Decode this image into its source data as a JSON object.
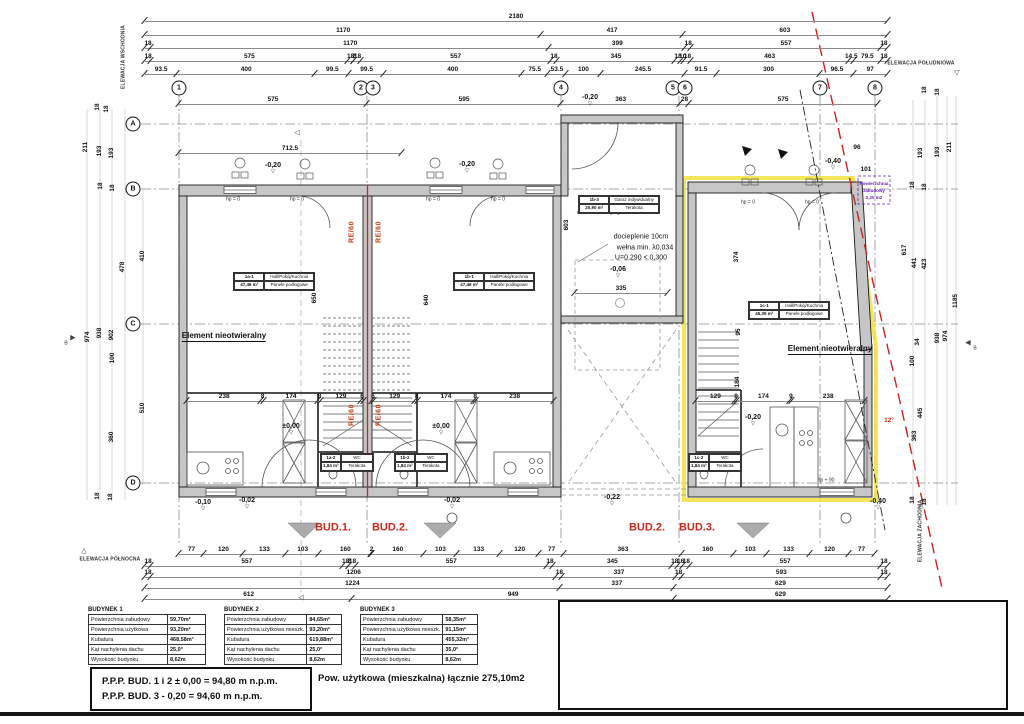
{
  "colors": {
    "highlight_yellow": "#f3e23c",
    "boundary_red": "#cc2222",
    "note_purple": "#6a1fb8",
    "wall_gray": "#c6c6c6"
  },
  "grid": {
    "cols": [
      [
        "1",
        179
      ],
      [
        "2",
        361
      ],
      [
        "3",
        373
      ],
      [
        "4",
        561
      ],
      [
        "5",
        673
      ],
      [
        "6",
        685
      ],
      [
        "7",
        820
      ],
      [
        "8",
        875
      ]
    ],
    "rows": [
      [
        "A",
        124
      ],
      [
        "B",
        189
      ],
      [
        "C",
        324
      ],
      [
        "D",
        483
      ]
    ]
  },
  "dim_rows": [
    {
      "x": 145,
      "y": 12,
      "w": 742,
      "vals": [
        "2180"
      ]
    },
    {
      "x": 145,
      "y": 26,
      "w": 742,
      "vals": [
        "1170",
        "417",
        "603"
      ]
    },
    {
      "x": 145,
      "y": 39,
      "w": 742,
      "vals": [
        "18",
        "1170",
        "399",
        "18",
        "557",
        "18"
      ]
    },
    {
      "x": 145,
      "y": 52,
      "w": 742,
      "vals": [
        "18",
        "575",
        "18",
        "2",
        "18",
        "557",
        "18",
        "345",
        "18",
        "10",
        "18",
        "463",
        "14.5",
        "79.5",
        "18"
      ]
    },
    {
      "x": 145,
      "y": 65,
      "w": 742,
      "vals": [
        "93.5",
        "400",
        "99.5",
        "99.5",
        "400",
        "75.5",
        "53.5",
        "100",
        "245.5",
        "91.5",
        "300",
        "96.5",
        "97"
      ]
    },
    {
      "x": 179,
      "y": 95,
      "w": 698,
      "vals": [
        "575",
        "595",
        "363",
        "28",
        "575"
      ]
    },
    {
      "x": 179,
      "y": 144,
      "w": 222,
      "vals": [
        "712.5"
      ]
    },
    {
      "x": 575,
      "y": 284,
      "w": 92,
      "vals": [
        "335"
      ]
    },
    {
      "x": 187,
      "y": 392,
      "w": 176,
      "vals": [
        "238",
        "8",
        "174",
        "8",
        "129",
        "6"
      ]
    },
    {
      "x": 372,
      "y": 392,
      "w": 181,
      "vals": [
        "6",
        "129",
        "8",
        "174",
        "8",
        "238"
      ]
    },
    {
      "x": 696,
      "y": 392,
      "w": 168,
      "vals": [
        "129",
        "8",
        "174",
        "9",
        "238"
      ]
    },
    {
      "x": 179,
      "y": 545,
      "w": 695,
      "vals": [
        "77",
        "120",
        "133",
        "103",
        "160",
        "2",
        "160",
        "103",
        "133",
        "120",
        "77",
        "363",
        "160",
        "103",
        "133",
        "120",
        "77"
      ]
    },
    {
      "x": 145,
      "y": 557,
      "w": 742,
      "vals": [
        "18",
        "557",
        "18",
        "2",
        "18",
        "557",
        "18",
        "345",
        "18",
        "16",
        "18",
        "557",
        "18"
      ]
    },
    {
      "x": 145,
      "y": 568,
      "w": 742,
      "vals": [
        "18",
        "1206",
        "18",
        "337",
        "18",
        "593",
        "18"
      ]
    },
    {
      "x": 145,
      "y": 579,
      "w": 742,
      "vals": [
        "1224",
        "337",
        "629"
      ]
    },
    {
      "x": 145,
      "y": 590,
      "w": 742,
      "vals": [
        "612",
        "949",
        "629"
      ]
    }
  ],
  "annotations": [
    [
      "211",
      86,
      147,
      "dv"
    ],
    [
      "193",
      100,
      151,
      "dv"
    ],
    [
      "193",
      112,
      153,
      "dv"
    ],
    [
      "18",
      98,
      107,
      "dv"
    ],
    [
      "18",
      107,
      109,
      "dv"
    ],
    [
      "18",
      101,
      186,
      "dv"
    ],
    [
      "18",
      113,
      188,
      "dv"
    ],
    [
      "478",
      123,
      267,
      "dv"
    ],
    [
      "410",
      143,
      256,
      "dv"
    ],
    [
      "938",
      100,
      333,
      "dv"
    ],
    [
      "902",
      112,
      335,
      "dv"
    ],
    [
      "974",
      88,
      337,
      "dv"
    ],
    [
      "100",
      113,
      358,
      "dv"
    ],
    [
      "510",
      143,
      408,
      "dv"
    ],
    [
      "360",
      112,
      437,
      "dv"
    ],
    [
      "18",
      98,
      496,
      "dv"
    ],
    [
      "18",
      111,
      497,
      "dv"
    ],
    [
      "18",
      925,
      90,
      "dv"
    ],
    [
      "18",
      938,
      92,
      "dv"
    ],
    [
      "193",
      921,
      153,
      "dv"
    ],
    [
      "193",
      938,
      152,
      "dv"
    ],
    [
      "211",
      950,
      147,
      "dv"
    ],
    [
      "18",
      913,
      185,
      "dv"
    ],
    [
      "18",
      925,
      187,
      "dv"
    ],
    [
      "441",
      915,
      263,
      "dv"
    ],
    [
      "423",
      925,
      264,
      "dv"
    ],
    [
      "617",
      905,
      250,
      "dv"
    ],
    [
      "938",
      938,
      338,
      "dv"
    ],
    [
      "974",
      946,
      336,
      "dv"
    ],
    [
      "1185",
      956,
      301,
      "dv"
    ],
    [
      "100",
      913,
      361,
      "dv"
    ],
    [
      "34",
      918,
      342,
      "dv"
    ],
    [
      "445",
      921,
      413,
      "dv"
    ],
    [
      "363",
      915,
      436,
      "dv"
    ],
    [
      "18",
      913,
      500,
      "dv"
    ],
    [
      "18",
      925,
      502,
      "dv"
    ],
    [
      "96",
      857,
      148,
      "d"
    ],
    [
      "101",
      866,
      170,
      "d"
    ],
    [
      "650",
      315,
      298,
      "dv"
    ],
    [
      "640",
      427,
      300,
      "dv"
    ],
    [
      "603",
      567,
      225,
      "dv"
    ],
    [
      "374",
      737,
      257,
      "dv"
    ],
    [
      "95",
      739,
      332,
      "dv"
    ],
    [
      "184",
      738,
      382,
      "dv"
    ],
    [
      "158",
      739,
      462,
      "dv"
    ],
    [
      "-0,20",
      273,
      168,
      "l"
    ],
    [
      "-0,20",
      467,
      167,
      "l"
    ],
    [
      "-0,20",
      590,
      100,
      "l"
    ],
    [
      "-0,20",
      753,
      420,
      "l"
    ],
    [
      "±0,00",
      291,
      429,
      "l"
    ],
    [
      "±0,00",
      441,
      429,
      "l"
    ],
    [
      "-0,06",
      618,
      272,
      "l"
    ],
    [
      "-0,10",
      203,
      505,
      "l"
    ],
    [
      "-0,02",
      247,
      503,
      "l"
    ],
    [
      "-0,02",
      452,
      503,
      "l"
    ],
    [
      "-0,22",
      612,
      500,
      "l"
    ],
    [
      "-0,40",
      833,
      164,
      "l"
    ],
    [
      "-0,40",
      878,
      504,
      "l"
    ],
    [
      "BUD.1.",
      333,
      528,
      "r"
    ],
    [
      "BUD.2.",
      390,
      528,
      "r"
    ],
    [
      "BUD.2.",
      647,
      528,
      "r"
    ],
    [
      "BUD.3.",
      697,
      528,
      "r"
    ],
    [
      "RE/60",
      352,
      232,
      "rv"
    ],
    [
      "RE/60",
      379,
      232,
      "rv"
    ],
    [
      "RE/60",
      352,
      415,
      "rv"
    ],
    [
      "RE/60",
      379,
      415,
      "rv"
    ],
    [
      "docieplenie 10cm",
      641,
      237,
      "n"
    ],
    [
      "wełna min. λ0,034",
      645,
      248,
      "n"
    ],
    [
      "U=0,290 < 0,300",
      641,
      258,
      "n"
    ],
    [
      "Element nieotwieralny",
      224,
      337,
      "nb"
    ],
    [
      "Element nieotwieralny",
      830,
      350,
      "nb"
    ],
    [
      "hp = 0",
      233,
      200,
      "t"
    ],
    [
      "hp = 0",
      297,
      200,
      "t"
    ],
    [
      "hp = 0",
      433,
      200,
      "t"
    ],
    [
      "hp = 0",
      498,
      200,
      "t"
    ],
    [
      "hp = 0",
      748,
      203,
      "t"
    ],
    [
      "hp = 0",
      812,
      203,
      "t"
    ],
    [
      "hp + 90",
      826,
      481,
      "t"
    ],
    [
      "B",
      66,
      344,
      "t"
    ],
    [
      "B",
      975,
      349,
      "t"
    ],
    [
      "▶",
      73,
      338,
      "g"
    ],
    [
      "◀",
      968,
      343,
      "g"
    ],
    [
      "◁",
      297,
      133,
      "g"
    ],
    [
      "◁",
      301,
      598,
      "g"
    ],
    [
      "▽",
      957,
      73,
      "g"
    ],
    [
      "△",
      84,
      551,
      "g"
    ],
    [
      "△",
      921,
      506,
      "g"
    ],
    [
      "ELEWACJA POŁUDNIOWA",
      921,
      64,
      "e"
    ],
    [
      "ELEWACJA PÓŁNOCNA",
      110,
      560,
      "e"
    ],
    [
      "ELEWACJA WSCHODNIA",
      124,
      57,
      "ev"
    ],
    [
      "ELEWACJA ZACHODNIA",
      921,
      531,
      "ev"
    ],
    [
      "Powierzchnia",
      874,
      184,
      "p"
    ],
    [
      "zabudowy",
      874,
      191,
      "p"
    ],
    [
      "2,20 m2",
      874,
      198,
      "p"
    ],
    [
      "12°",
      889,
      421,
      "ag"
    ]
  ],
  "room_tables": [
    {
      "x": 233,
      "y": 272,
      "w": 80,
      "id": "1a-1",
      "name": "Hall/Pokój/Kuchnia",
      "area": "47,46 m²",
      "floor": "Panele podłogowe"
    },
    {
      "x": 453,
      "y": 272,
      "w": 80,
      "id": "1b-1",
      "name": "Hall/Pokój/Kuchnia",
      "area": "47,46 m²",
      "floor": "Panele podłogowe"
    },
    {
      "x": 748,
      "y": 301,
      "w": 80,
      "id": "1c-1",
      "name": "Hall/Pokój/Kuchnia",
      "area": "45,35 m²",
      "floor": "Panele podłogowe"
    },
    {
      "x": 578,
      "y": 195,
      "w": 80,
      "id": "1b-3",
      "name": "Garaż indywidualny",
      "area": "20,90 m²",
      "floor": "Terakota",
      "caption": "Pomieszczenie przynależne lokalu \"b\""
    },
    {
      "x": 320,
      "y": 453,
      "w": 52,
      "id": "1a-2",
      "name": "WC",
      "area": "1,84 m²",
      "floor": "Terakota"
    },
    {
      "x": 394,
      "y": 453,
      "w": 52,
      "id": "1b-2",
      "name": "WC",
      "area": "1,84 m²",
      "floor": "Terakota"
    },
    {
      "x": 688,
      "y": 453,
      "w": 52,
      "id": "1c-2",
      "name": "WC",
      "area": "1,84 m²",
      "floor": "Terakota"
    }
  ],
  "summary_tables": [
    {
      "title": "BUDYNEK 1",
      "x": 88,
      "rows": [
        [
          "Powierzchnia zabudowy",
          "59,70m²"
        ],
        [
          "Powierzchnia użytkowa",
          "93,20m²"
        ],
        [
          "Kubatura",
          "468,58m³"
        ],
        [
          "Kąt nachylenia dachu",
          "25,0°"
        ],
        [
          "Wysokość budynku",
          "8,62m"
        ]
      ]
    },
    {
      "title": "BUDYNEK 2",
      "x": 224,
      "rows": [
        [
          "Powierzchnia zabudowy",
          "84,65m²"
        ],
        [
          "Powierzchnia użytkowa mieszk.",
          "93,20m²"
        ],
        [
          "Kubatura",
          "619,88m³"
        ],
        [
          "Kąt nachylenia dachu",
          "25,0°"
        ],
        [
          "Wysokość budynku",
          "8,62m"
        ]
      ]
    },
    {
      "title": "BUDYNEK 3",
      "x": 360,
      "rows": [
        [
          "Powierzchnia zabudowy",
          "58,35m²"
        ],
        [
          "Powierzchnia użytkowa mieszk.",
          "91,15m²"
        ],
        [
          "Kubatura",
          "455,32m³"
        ],
        [
          "Kąt nachylenia dachu",
          "35,0°"
        ],
        [
          "Wysokość budynku",
          "8,62m"
        ]
      ]
    }
  ],
  "footer": {
    "ppp_lines": [
      "P.P.P.  BUD. 1 i 2   ± 0,00 = 94,80 m n.p.m.",
      "P.P.P.  BUD. 3    - 0,20 = 94,60 m n.p.m."
    ],
    "total": "Pow. użytkowa (mieszkalna)  łącznie 275,10m2"
  }
}
